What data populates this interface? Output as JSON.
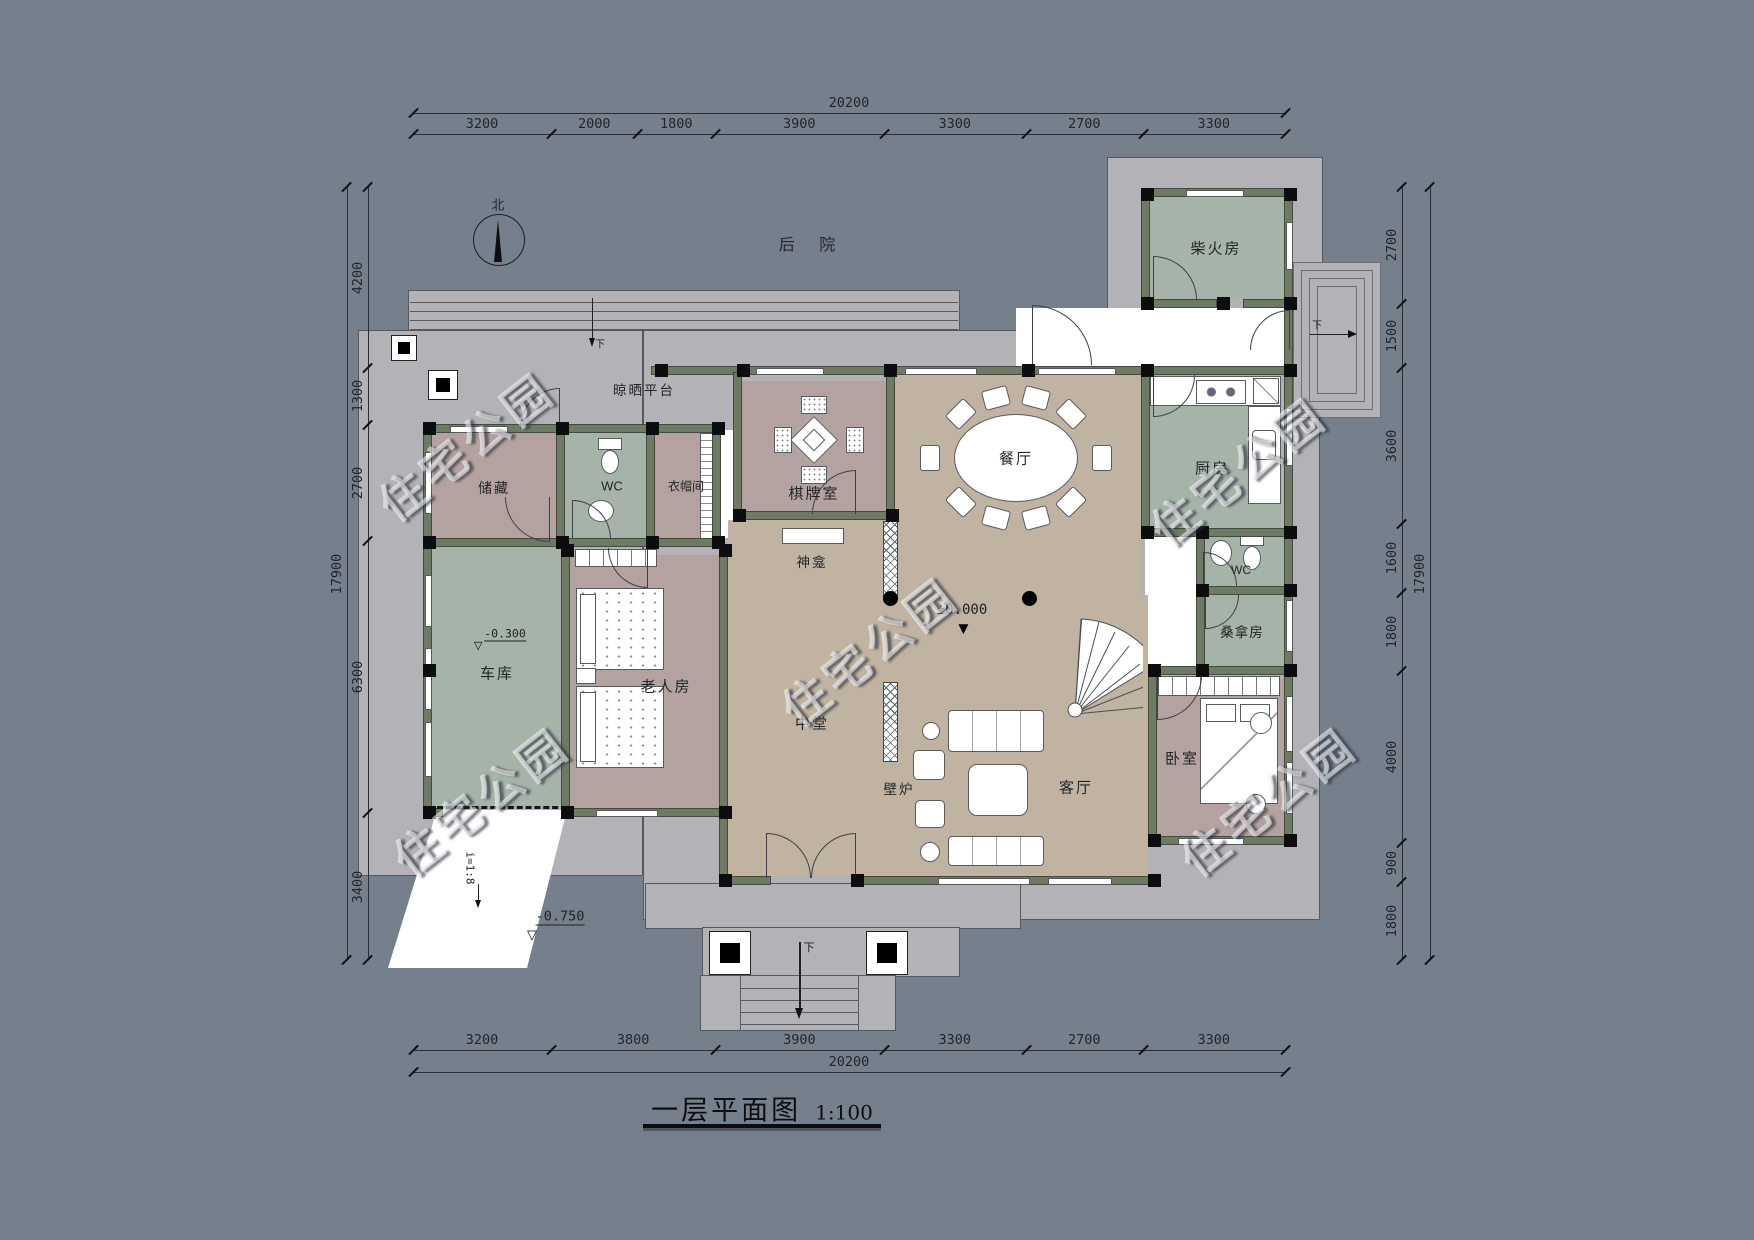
{
  "title": {
    "text": "一层平面图",
    "scale": "1:100"
  },
  "compass": {
    "label": "北"
  },
  "areas": {
    "backyard": "后 院",
    "drying_platform": "晾晒平台"
  },
  "watermark": "住宅公园",
  "rooms": {
    "firewood": "柴火房",
    "kitchen": "厨房",
    "wc_right": "WC",
    "sauna": "桑拿房",
    "bedroom": "卧室",
    "living": "客厅",
    "dining": "餐厅",
    "mahjong": "棋牌室",
    "shrine": "神龛",
    "hall": "中堂",
    "fireplace": "壁炉",
    "elderly": "老人房",
    "garage": "车库",
    "storage": "储藏",
    "wc_left": "WC",
    "cloakroom": "衣帽间"
  },
  "levels": {
    "main": "±0.000",
    "entrance": "-0.750",
    "garage": "-0.300"
  },
  "slope": "i=1:8",
  "stairs": {
    "down": "下"
  },
  "dimensions": {
    "top": {
      "total": "20200",
      "segments": [
        3200,
        2000,
        1800,
        3900,
        3300,
        2700,
        3300
      ]
    },
    "bottom": {
      "total": "20200",
      "segments": [
        3200,
        3800,
        3900,
        3300,
        2700,
        3300
      ]
    },
    "left": {
      "total": "17900",
      "segments": [
        4200,
        1300,
        2700,
        6300,
        3400
      ]
    },
    "right": {
      "total": "17900",
      "segments": [
        2700,
        1500,
        3600,
        1600,
        1800,
        4000,
        900,
        1800
      ]
    }
  },
  "colors": {
    "background": "#75808c",
    "plate": "#b3b2b7",
    "wall": "#6e7a64",
    "floor_tan": "#c0b3a2",
    "floor_sage": "#a6b3a9",
    "floor_mauve": "#b3a2a0"
  }
}
